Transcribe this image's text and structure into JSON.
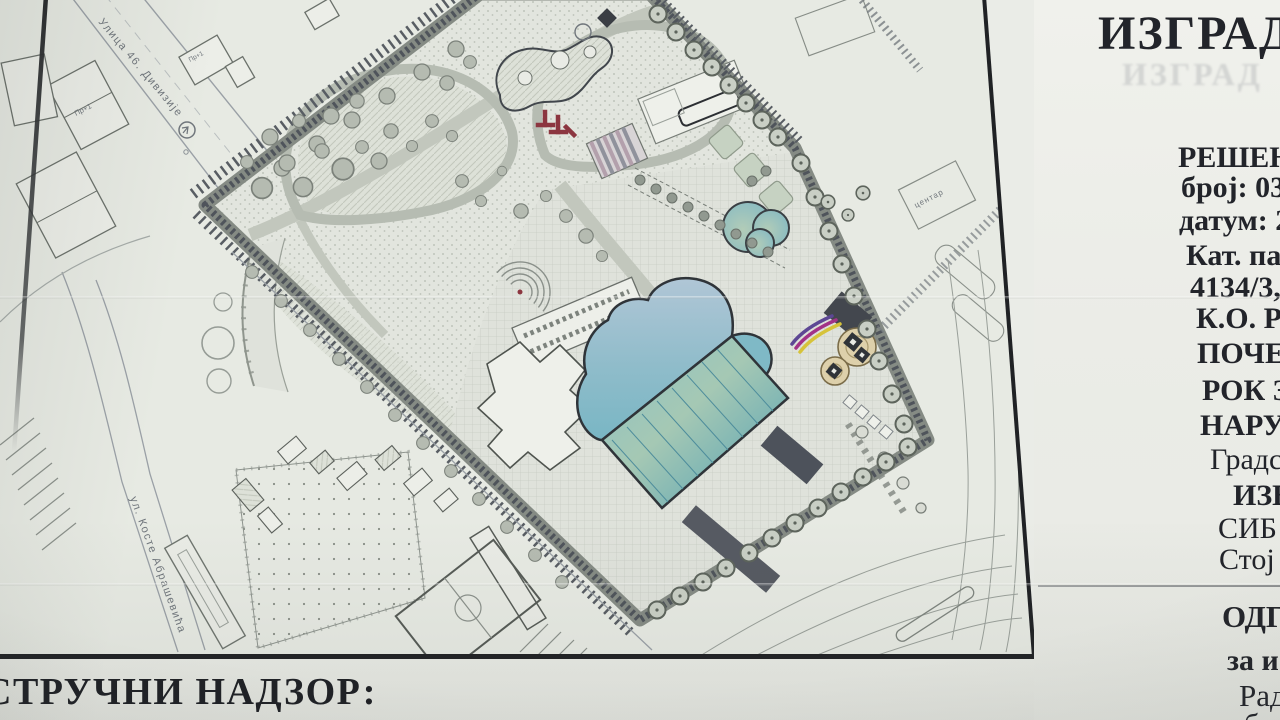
{
  "board": {
    "title": "ИЗГРАДЊ",
    "title_ghost": "ИЗГРАД",
    "supervision_heading": "СТРУЧНИ НАДЗОР:",
    "details": [
      {
        "text": "РЕШЕЊ"
      },
      {
        "text": "број: 03-"
      },
      {
        "text": "датум: 2"
      },
      {
        "text": "Кат. пар"
      },
      {
        "text": "4134/3,"
      },
      {
        "text": "К.О. Ри"
      },
      {
        "text": "ПОЧЕТ"
      },
      {
        "text": "РОК З"
      },
      {
        "text": "НАРУ"
      },
      {
        "text": "Градс"
      },
      {
        "text": "ИЗВО"
      },
      {
        "text": "СИБ"
      },
      {
        "text": "Стој"
      },
      {
        "text": "ОДГ"
      },
      {
        "text": "за и"
      },
      {
        "text": "Рад"
      },
      {
        "text": "б"
      }
    ]
  },
  "site_plan": {
    "street_labels": [
      {
        "text": "Улица 46. Дивизије"
      },
      {
        "text": "ул. Косте Абрашевића"
      },
      {
        "text": "центар"
      }
    ],
    "building_labels": [
      {
        "text": "Пр+1"
      },
      {
        "text": "Пр+1"
      }
    ]
  },
  "colors": {
    "pool_deep": "#54a4b8",
    "pool_light": "#aec6d6",
    "slide_yellow": "#d6c33a",
    "slide_magenta": "#a23287",
    "slide_purple": "#5d4794",
    "playground_red": "#8c3640",
    "frame_black": "#202225",
    "board_white": "#ecede8"
  }
}
